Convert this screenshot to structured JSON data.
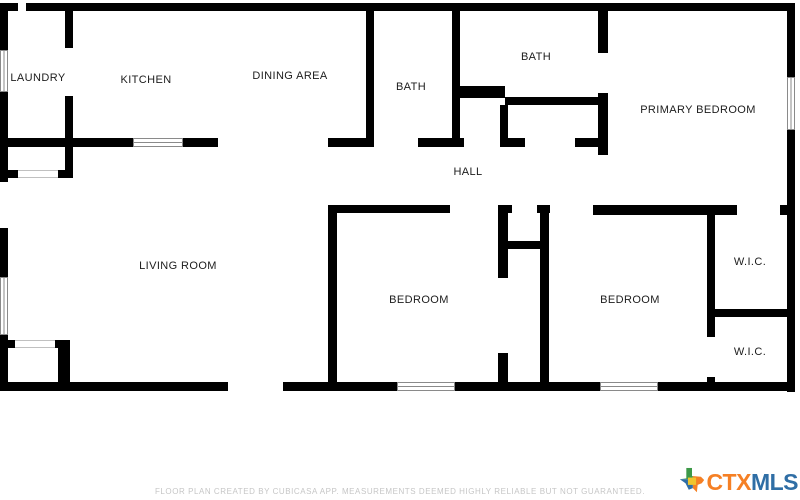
{
  "floor_plan": {
    "rooms": [
      {
        "id": "laundry",
        "label": "LAUNDRY"
      },
      {
        "id": "kitchen",
        "label": "KITCHEN"
      },
      {
        "id": "dining-area",
        "label": "DINING AREA"
      },
      {
        "id": "bath-1",
        "label": "BATH"
      },
      {
        "id": "bath-2",
        "label": "BATH"
      },
      {
        "id": "primary-bedroom",
        "label": "PRIMARY BEDROOM"
      },
      {
        "id": "hall",
        "label": "HALL"
      },
      {
        "id": "living-room",
        "label": "LIVING ROOM"
      },
      {
        "id": "bedroom-1",
        "label": "BEDROOM"
      },
      {
        "id": "bedroom-2",
        "label": "BEDROOM"
      },
      {
        "id": "wic-1",
        "label": "W.I.C."
      },
      {
        "id": "wic-2",
        "label": "W.I.C."
      }
    ]
  },
  "footer": {
    "disclaimer": "FLOOR PLAN CREATED BY CUBICASA APP. MEASUREMENTS DEEMED HIGHLY RELIABLE BUT NOT GUARANTEED."
  },
  "logo": {
    "ctx": "CTX",
    "mls": "MLS",
    "ctx_color": "#f58025",
    "mls_color": "#2f6ea5",
    "texas_colors": {
      "green": "#3d9948",
      "orange": "#f58025",
      "blue": "#2f6ea5",
      "yellow": "#f0c52e"
    }
  },
  "colors": {
    "wall": "#000000",
    "background": "#ffffff",
    "room_label": "#1c1c1c",
    "window_line": "#8a8a8a",
    "footer_text": "#c6c6c6"
  }
}
